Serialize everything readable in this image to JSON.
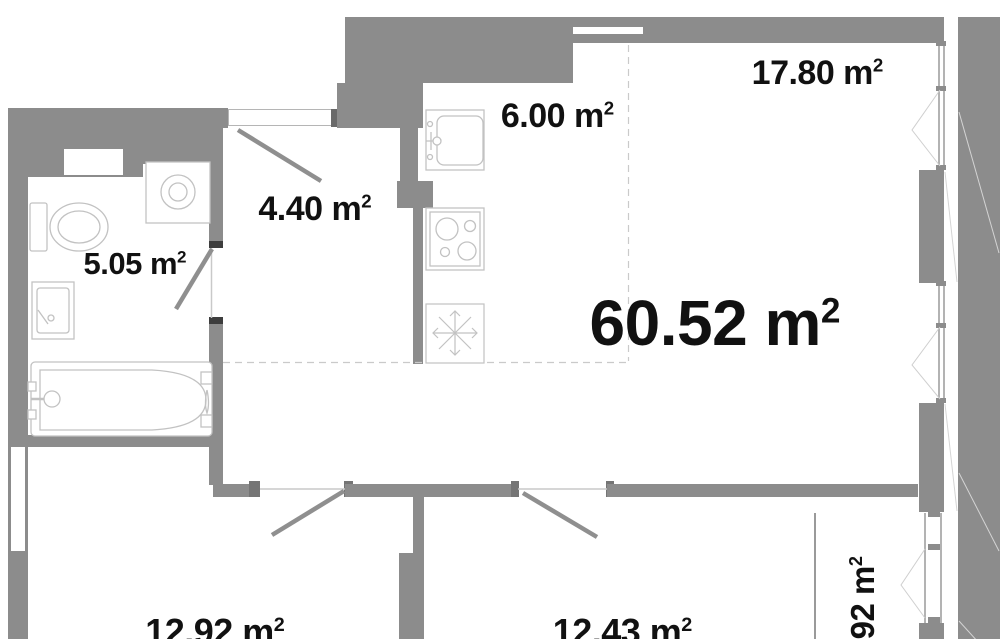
{
  "plan": {
    "unit_superscript": "2",
    "rooms": {
      "total": {
        "area": "60.52 m"
      },
      "living": {
        "area": "17.80 m"
      },
      "kitchen": {
        "area": "6.00 m"
      },
      "hallway": {
        "area": "4.40 m"
      },
      "bathroom": {
        "area": "5.05 m"
      },
      "room_left": {
        "area": "12.92 m"
      },
      "room_center": {
        "area": "12.43 m"
      },
      "balcony": {
        "area": ".92 m"
      }
    },
    "colors": {
      "wall": "#8c8c8c",
      "fixture_outline": "#c2c2c2",
      "door_swing": "#8f8f8f",
      "text": "#111111"
    }
  }
}
